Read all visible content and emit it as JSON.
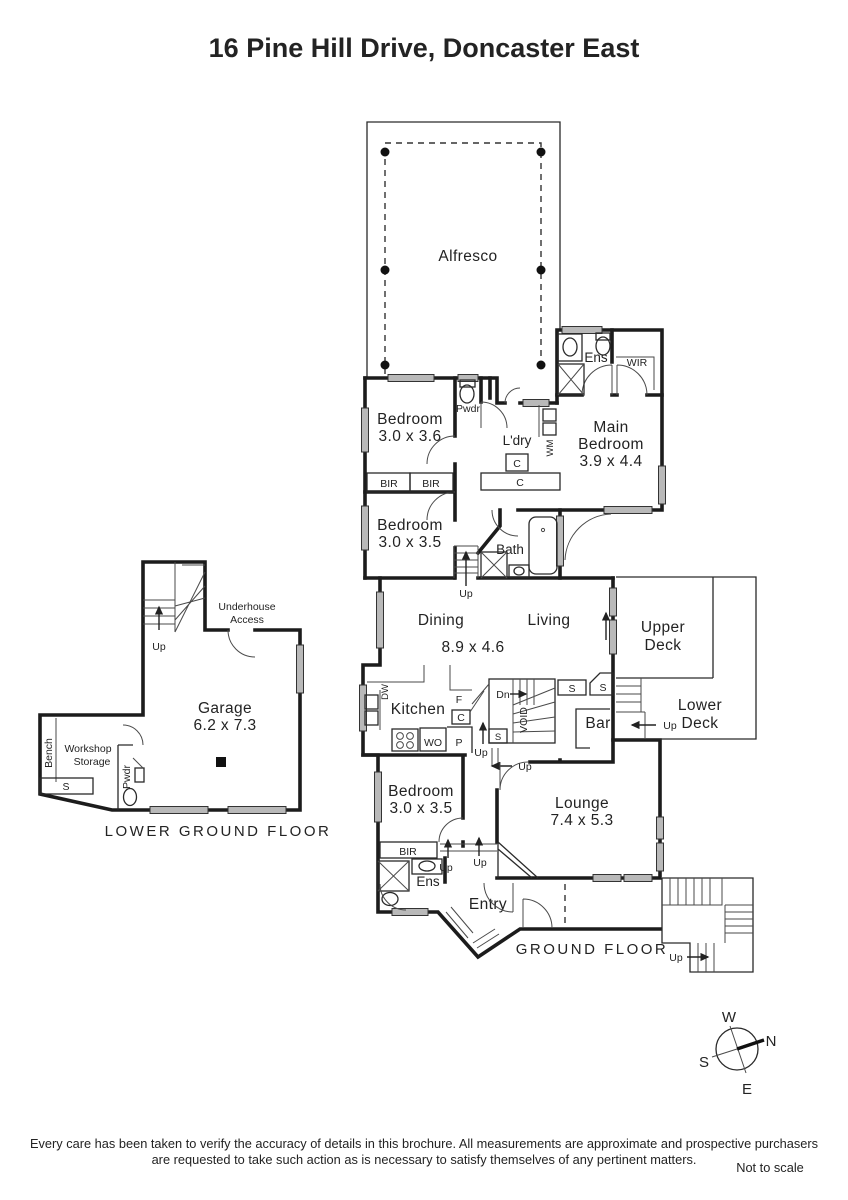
{
  "title": "16 Pine Hill Drive, Doncaster East",
  "upper": {
    "alfresco": "Alfresco",
    "ens": "Ens",
    "wir": "WIR",
    "pwdr": "Pwdr",
    "bedroom1_name": "Bedroom",
    "bedroom1_dim": "3.0 x 3.6",
    "ldry": "L'dry",
    "wm": "WM",
    "c1": "C",
    "c2": "C",
    "main1": "Main",
    "main2": "Bedroom",
    "main_dim": "3.9 x 4.4",
    "bir1": "BIR",
    "bir2": "BIR",
    "bedroom2_name": "Bedroom",
    "bedroom2_dim": "3.0 x 3.5",
    "bath": "Bath",
    "up": "Up"
  },
  "ground": {
    "dining": "Dining",
    "living": "Living",
    "dining_dim": "8.9 x 4.6",
    "upper_deck1": "Upper",
    "upper_deck2": "Deck",
    "lower_deck1": "Lower",
    "lower_deck2": "Deck",
    "kitchen": "Kitchen",
    "dw": "DW",
    "f": "F",
    "c": "C",
    "p": "P",
    "wo": "WO",
    "dn": "Dn",
    "void": "VOID",
    "s1": "S",
    "s2": "S",
    "s3": "S",
    "bar": "Bar",
    "up1": "Up",
    "up2": "Up",
    "up3": "Up",
    "up4": "Up",
    "up5": "Up",
    "up6": "Up",
    "bedroom_name": "Bedroom",
    "bedroom_dim": "3.0 x 3.5",
    "lounge_name": "Lounge",
    "lounge_dim": "7.4 x 5.3",
    "bir": "BIR",
    "ens": "Ens",
    "entry": "Entry",
    "label": "GROUND FLOOR"
  },
  "lower": {
    "underhouse1": "Underhouse",
    "underhouse2": "Access",
    "up": "Up",
    "garage_name": "Garage",
    "garage_dim": "6.2 x 7.3",
    "bench": "Bench",
    "workshop1": "Workshop",
    "workshop2": "Storage",
    "s": "S",
    "pwdr": "Pwdr",
    "label": "LOWER GROUND FLOOR"
  },
  "compass": {
    "n": "N",
    "s": "S",
    "e": "E",
    "w": "W"
  },
  "footer": {
    "line1": "Every care has been taken to verify the accuracy of details in this brochure.  All measurements are approximate and prospective purchasers",
    "line2": "are requested to take such action as is necessary to satisfy themselves of any pertinent matters.",
    "scale": "Not to scale"
  },
  "colors": {
    "wall": "#1c1c1c",
    "window": "#b9b9b9"
  }
}
